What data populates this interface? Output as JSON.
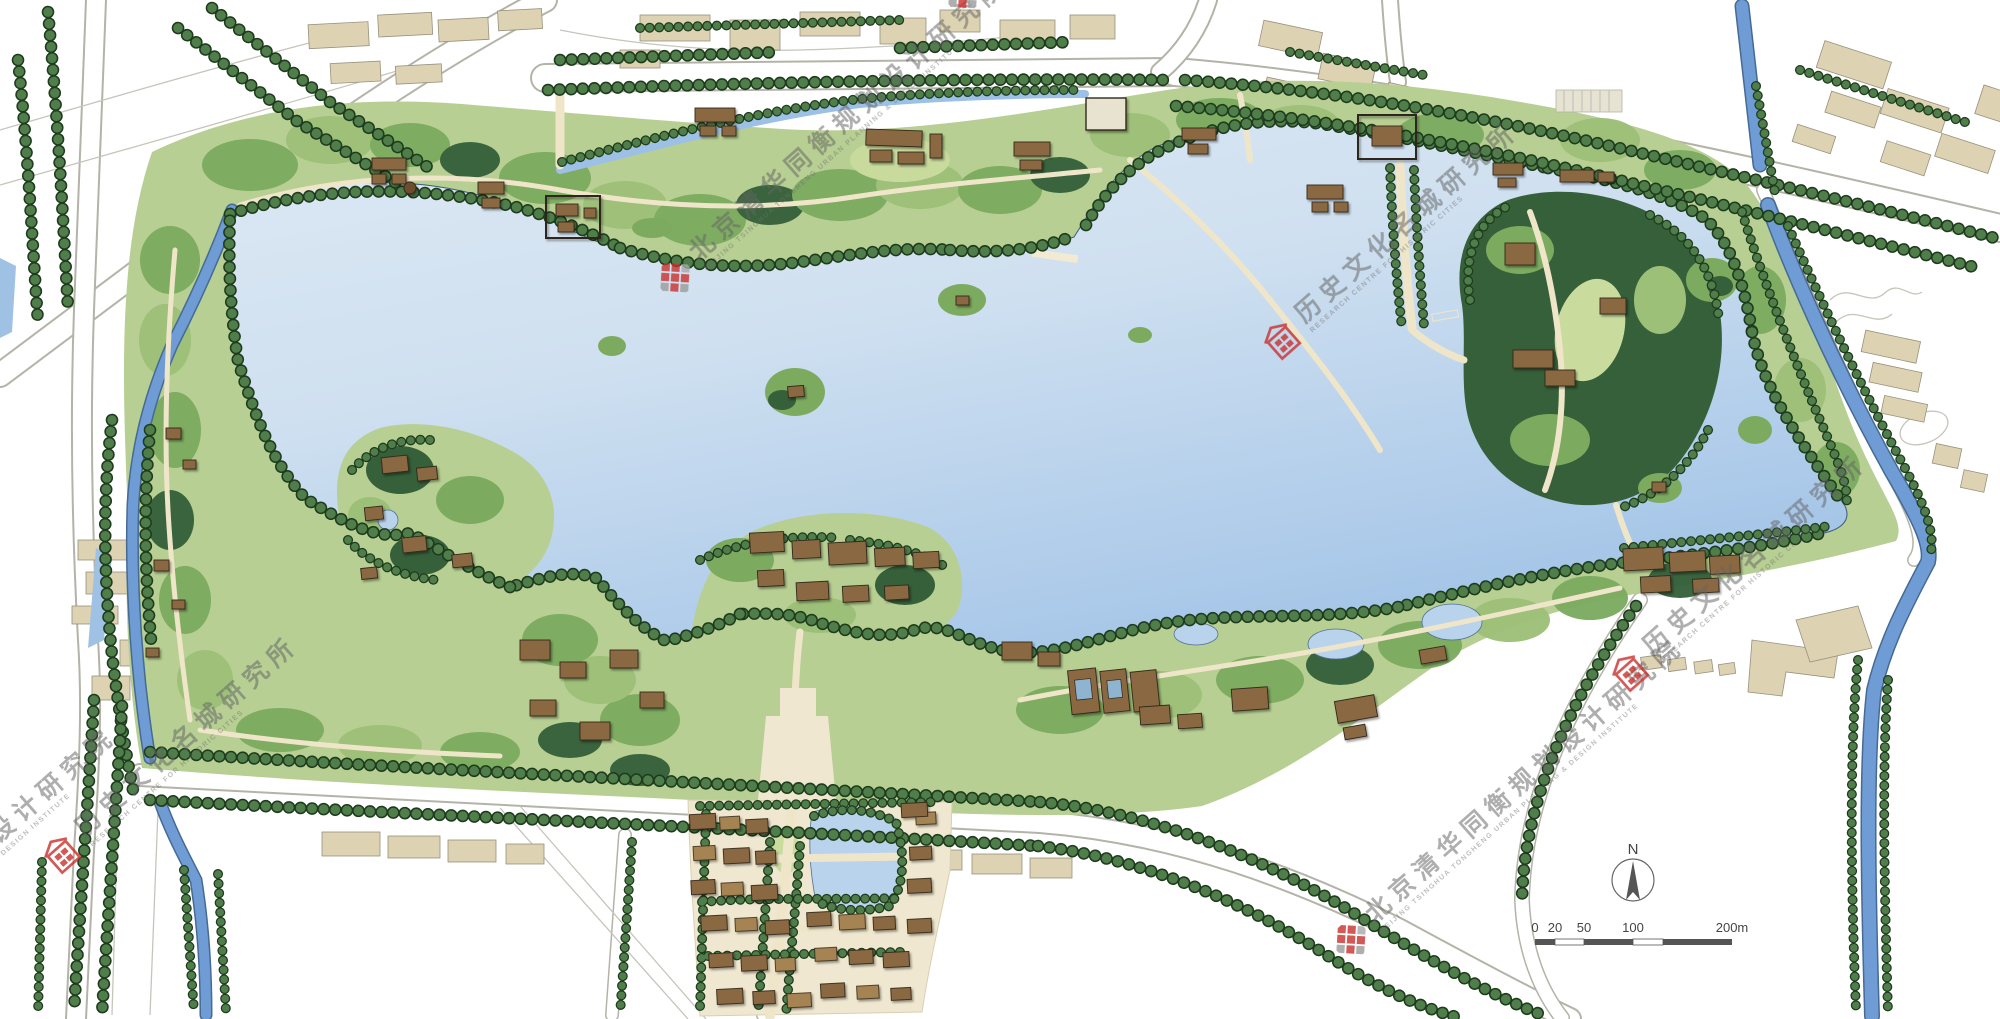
{
  "map": {
    "kind": "landscape master plan of a historic lake park",
    "colors": {
      "water_light": "#e8eef6",
      "water_mid": "#cfe0f0",
      "water_deep": "#a9c8e8",
      "canal": "#6f9cd4",
      "park_base": "#b7cf92",
      "canopy_mid": "#7cab60",
      "canopy_light": "#9dc078",
      "canopy_dark": "#35603a",
      "tree_dot": "#4f7e4a",
      "tree_dot_outline": "#1e3b1d",
      "path_cream": "#efe6ca",
      "building_city": "#ddd2b2",
      "building_historic": "#8a6742",
      "road_edge": "#b4b3a8",
      "watermark_red": "#c9302c",
      "watermark_gray": "#6e6e6e"
    },
    "north_indicator": {
      "label": "N"
    },
    "scale_bar": {
      "ticks": [
        "0",
        "20",
        "50",
        "100",
        "200m"
      ]
    },
    "watermarks": {
      "institute": {
        "cn": "北京清华同衡规划设计研究院",
        "en": "BEIJING TSINGHUA TONGHENG URBAN PLANNING & DESIGN INSTITUTE"
      },
      "historic": {
        "cn": "历史文化名城研究所",
        "en": "RESEARCH CENTRE FOR HISTORIC CITIES"
      }
    }
  }
}
